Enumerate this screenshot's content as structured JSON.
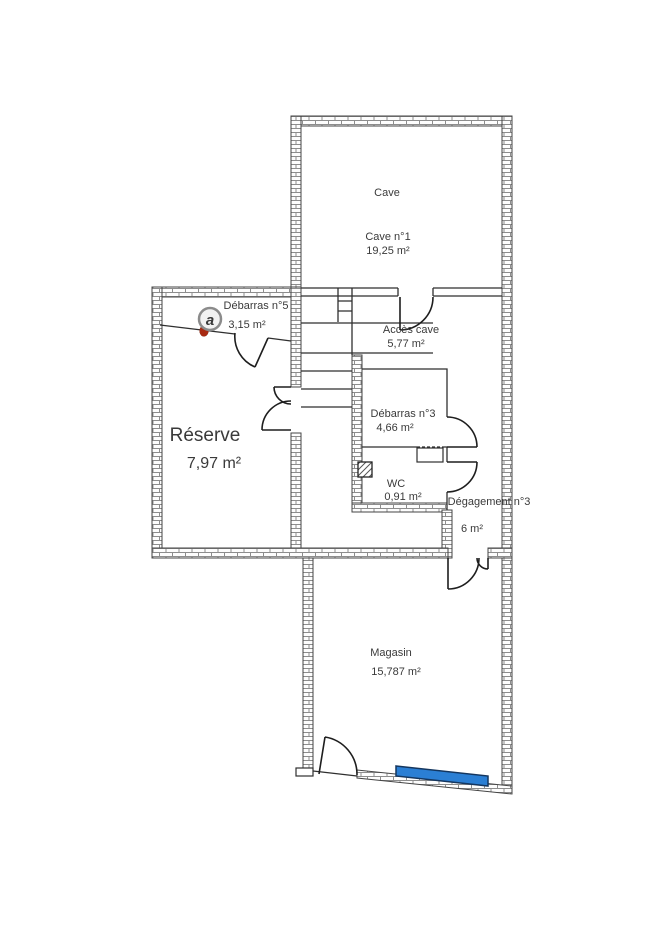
{
  "page": {
    "background": "#ffffff"
  },
  "plan": {
    "wall_color": "#444444",
    "line_color": "#2f2f2f",
    "display_color": "#2b7fd4",
    "display_border": "#14365f",
    "logo": {
      "letter": "a",
      "accent": "#a District22"
    },
    "rooms": {
      "cave": {
        "label": "Cave",
        "sublabel": "Cave n°1",
        "area": "19,25  m²"
      },
      "debarras5": {
        "label": "Débarras n°5",
        "area": "3,15  m²"
      },
      "acces_cave": {
        "label": "Accès cave",
        "area": "5,77  m²"
      },
      "debarras3": {
        "label": "Débarras n°3",
        "area": "4,66  m²"
      },
      "reserve": {
        "label": "Réserve",
        "area": "7,97  m²"
      },
      "wc": {
        "label": "WC",
        "area": "0,91  m²"
      },
      "degagement": {
        "label": "Dégagement n°3",
        "area": "6  m²"
      },
      "magasin": {
        "label": "Magasin",
        "area": "15,787  m²"
      }
    }
  }
}
